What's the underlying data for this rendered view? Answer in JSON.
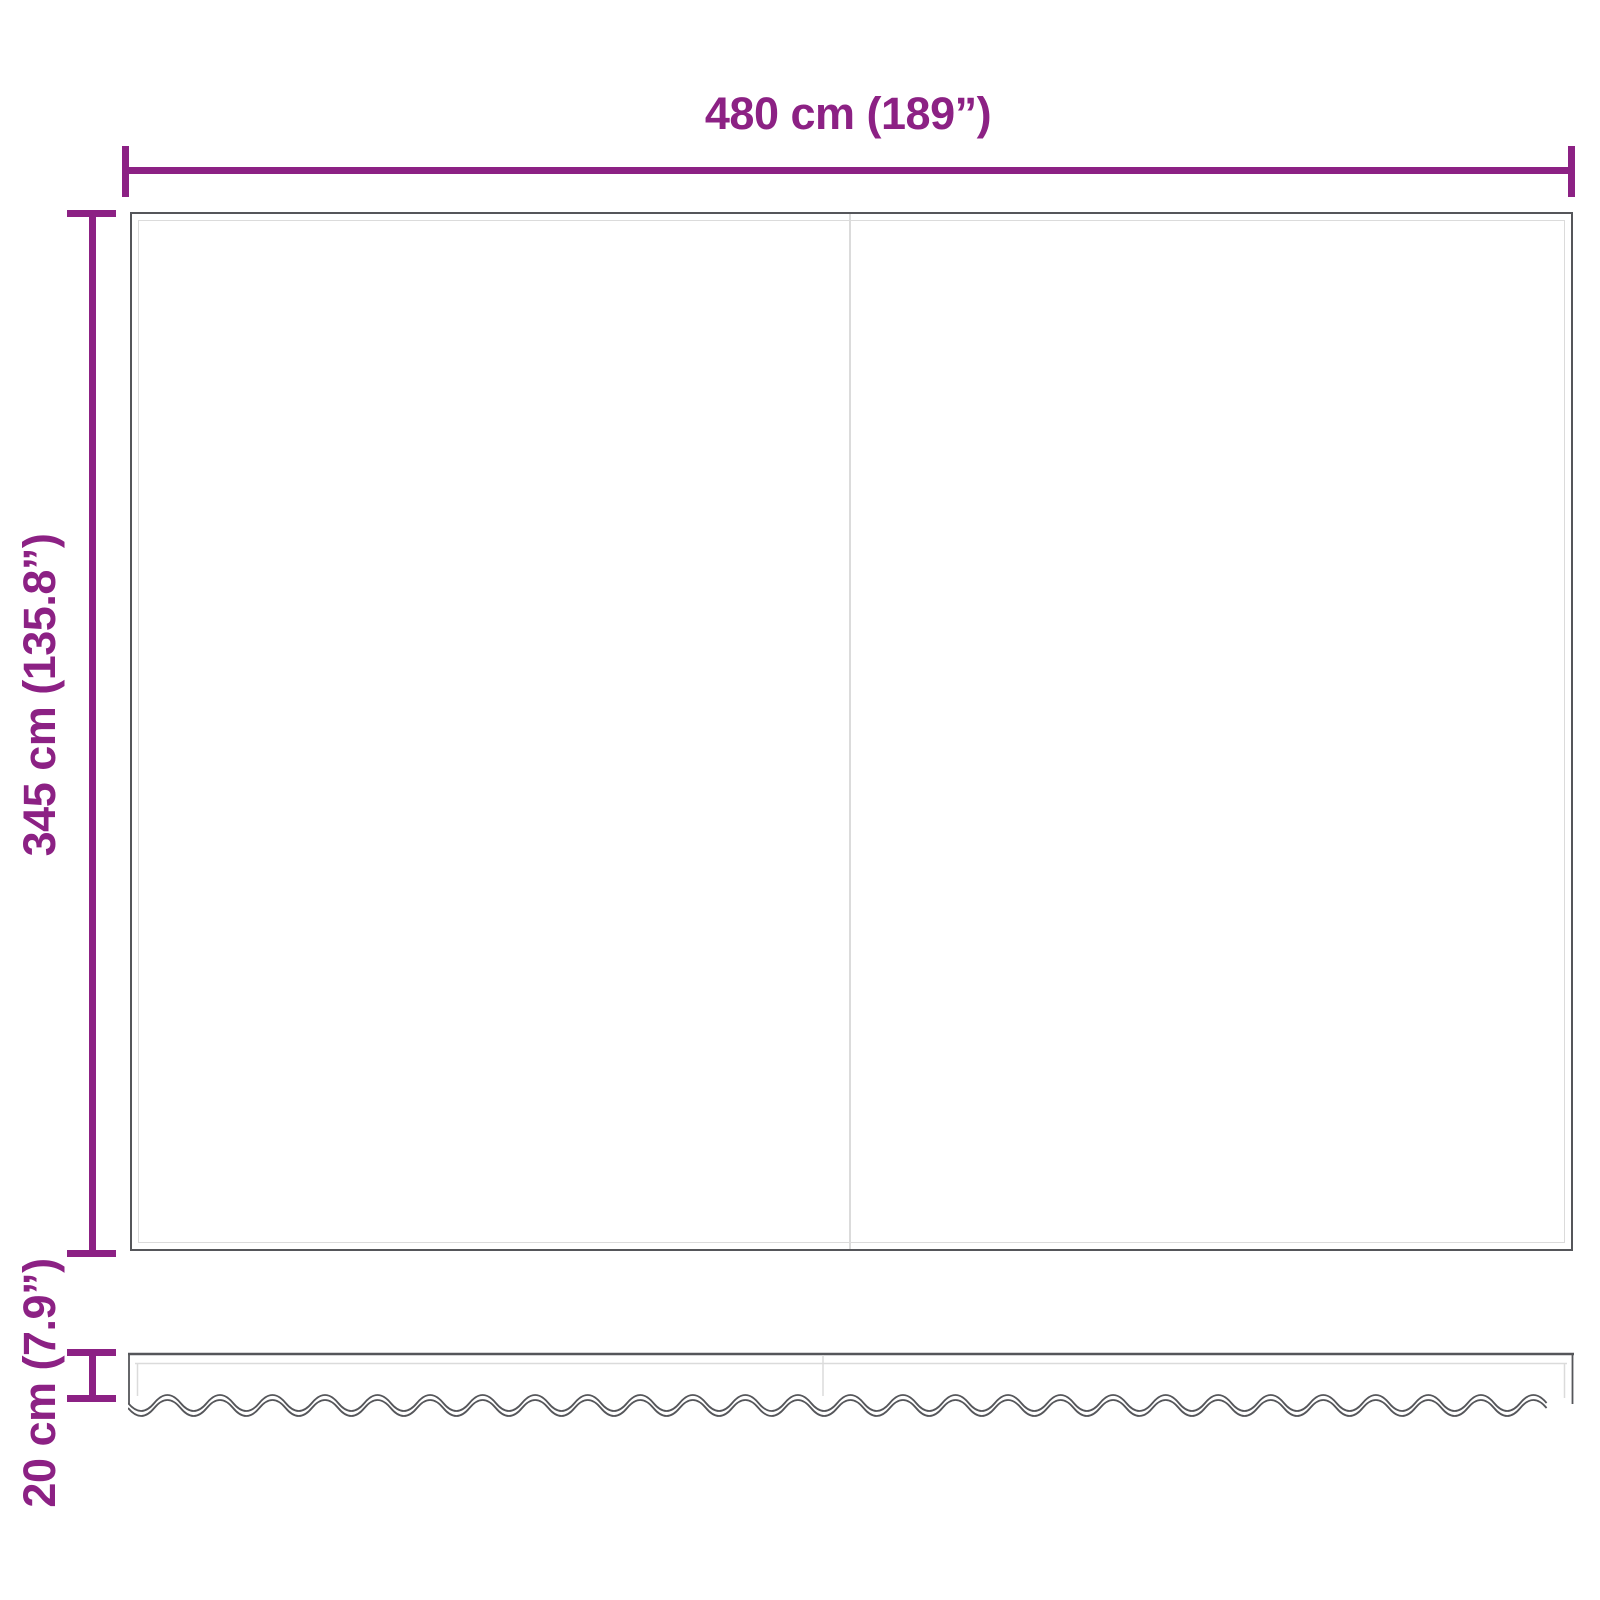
{
  "diagram": {
    "type": "product-dimension-diagram",
    "dimensions": {
      "width": {
        "label": "480 cm (189”)"
      },
      "height": {
        "label": "345 cm (135.8”)"
      },
      "valance": {
        "label": "20 cm (7.9”)"
      }
    },
    "colors": {
      "accent": "#8C2184",
      "outline": "#55565A",
      "inner_line": "#DBDBDB"
    }
  }
}
